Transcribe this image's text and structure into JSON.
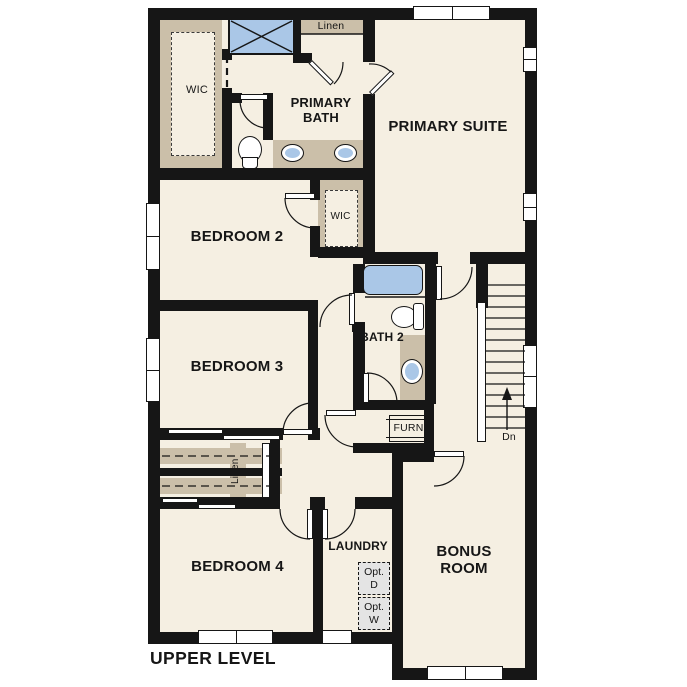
{
  "title": "UPPER LEVEL",
  "rooms": {
    "primary_suite": "PRIMARY SUITE",
    "primary_bath": "PRIMARY BATH",
    "wic_primary": "WIC",
    "linen_upper": "Linen",
    "bedroom2": "BEDROOM 2",
    "wic_bedroom2": "WIC",
    "bedroom3": "BEDROOM 3",
    "bath2": "BATH 2",
    "furnace": "FURN",
    "linen_hall": "Linen",
    "stairs_down": "Dn",
    "bedroom4": "BEDROOM 4",
    "laundry": "LAUNDRY",
    "optional_dryer": "Opt. D",
    "optional_washer": "Opt. W",
    "bonus_room": "BONUS ROOM"
  },
  "colors": {
    "floor": "#f5efe2",
    "walls": "#161616",
    "cabinetry_tan": "#cbbfa9",
    "fixture_blue": "#aac7e7",
    "appliance_gray": "#e4e4e4",
    "background": "#ffffff"
  }
}
